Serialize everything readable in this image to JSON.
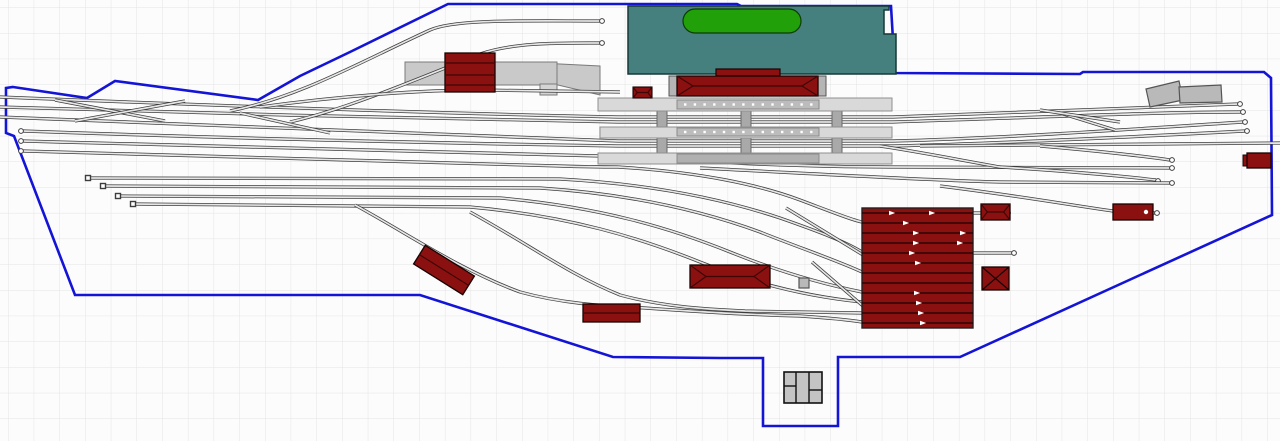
{
  "app": {
    "description": "model railway track plan canvas"
  },
  "scene": {
    "colors": {
      "bg": "#fcfcfc",
      "grid": "#e4e4e4",
      "boundary": "#1414d7",
      "rail": "#3d3d3d",
      "rail_gap": "#e6e6e6",
      "red": "#8b1111",
      "red_line": "#3f0606",
      "teal": "#46807e",
      "teal_stroke": "#17393a",
      "pond": "#22a00a",
      "pond_stroke": "#0c3b04",
      "platform": "#d9d9d9",
      "platform_stroke": "#909090",
      "strip": "#bcbcbc",
      "strip_dark": "#b0b0b0",
      "connector": "#a9a9a9",
      "gray_building": "#b9b9b9",
      "gray_building_stroke": "#555555",
      "goods_platform": "#c9c9c9",
      "goods_platform_stroke": "#7a7a7a"
    },
    "grid": {
      "size": 25.7,
      "offset_x": 8,
      "offset_y": 7.3
    },
    "boundary": {
      "points": [
        [
          13,
          87
        ],
        [
          87,
          98
        ],
        [
          115,
          81
        ],
        [
          258,
          100
        ],
        [
          300,
          76
        ],
        [
          350,
          52
        ],
        [
          448,
          4
        ],
        [
          737,
          4
        ],
        [
          741,
          6
        ],
        [
          891,
          6
        ],
        [
          893,
          40
        ],
        [
          893,
          73
        ],
        [
          1080,
          74
        ],
        [
          1083,
          72
        ],
        [
          1264,
          72
        ],
        [
          1271,
          78
        ],
        [
          1272,
          215
        ],
        [
          960,
          357
        ],
        [
          838,
          357
        ],
        [
          838,
          426
        ],
        [
          763,
          426
        ],
        [
          763,
          358
        ],
        [
          720,
          358
        ],
        [
          613,
          357
        ],
        [
          420,
          295
        ],
        [
          75,
          295
        ],
        [
          14,
          136
        ],
        [
          6,
          133
        ],
        [
          6,
          88
        ]
      ]
    },
    "park": {
      "points": [
        [
          628,
          6
        ],
        [
          889,
          6
        ],
        [
          889,
          10
        ],
        [
          884,
          10
        ],
        [
          884,
          34
        ],
        [
          896,
          34
        ],
        [
          896,
          74
        ],
        [
          628,
          74
        ]
      ],
      "pond": {
        "x": 683,
        "y": 9,
        "w": 118,
        "h": 24,
        "rx": 12
      }
    },
    "goods_area": {
      "platform": {
        "x": 405,
        "y": 62,
        "w": 152,
        "h": 23
      },
      "trapezoid": [
        [
          540,
          63
        ],
        [
          600,
          66
        ],
        [
          600,
          95
        ],
        [
          558,
          85
        ],
        [
          540,
          84
        ]
      ],
      "step": {
        "x": 540,
        "y": 84,
        "w": 17,
        "h": 11
      },
      "building": {
        "x": 445,
        "y": 53,
        "w": 50,
        "h": 39,
        "lines": [
          63,
          75,
          85
        ]
      }
    },
    "tracks": [
      {
        "name": "main-west-1",
        "d": "M0,97 C200,105 420,113 618,117 L893,117 C1050,112 1160,106 1238,104",
        "ends": [
          [
            1240,
            104
          ]
        ]
      },
      {
        "name": "main-west-2",
        "d": "M0,107 C200,113 420,119 618,122 L893,122 C1050,117 1160,112 1241,112",
        "ends": [
          [
            1243,
            112
          ]
        ]
      },
      {
        "name": "main-west-3",
        "d": "M0,117 C200,124 430,135 618,141 L893,141 C1010,138 1150,128 1243,122",
        "ends": [
          [
            1245,
            122
          ]
        ]
      },
      {
        "name": "yard-track-1",
        "d": "M23,131 C220,138 430,143 618,146 L893,146 C1010,143 1150,136 1245,131",
        "ends": [
          [
            21,
            131
          ],
          [
            1247,
            131
          ]
        ]
      },
      {
        "name": "yard-track-2",
        "d": "M23,141 C230,147 440,152 600,156 C700,162 800,167 893,167 L1170,168",
        "ends": [
          [
            21,
            141
          ],
          [
            1172,
            168
          ]
        ]
      },
      {
        "name": "yard-track-3",
        "d": "M23,151 C240,158 420,163 560,166 C590,167 610,167 618,167",
        "ends": [
          [
            21,
            151
          ]
        ]
      },
      {
        "name": "through-east",
        "d": "M920,146 C1000,145 1100,144 1280,143",
        "ends": []
      },
      {
        "name": "siding-east-1",
        "d": "M1040,146 C1100,151 1150,157 1170,160",
        "ends": [
          [
            1172,
            160
          ]
        ]
      },
      {
        "name": "siding-east-2",
        "d": "M1000,167 C1080,172 1130,177 1156,180",
        "ends": [
          [
            1158,
            181
          ]
        ]
      },
      {
        "name": "goods-track-1",
        "d": "M230,111 C300,97 360,62 430,30 C455,19 520,21 600,21",
        "ends": [
          [
            602,
            21
          ]
        ]
      },
      {
        "name": "goods-track-2",
        "d": "M290,122 C350,108 420,78 480,54 C515,42 560,43 600,43",
        "ends": [
          [
            602,
            43
          ]
        ]
      },
      {
        "name": "goods-track-3",
        "d": "M260,107 C340,96 420,90 480,90 L620,92",
        "ends": []
      },
      {
        "name": "stub-track-1",
        "d": "M88,178 L560,179 C650,184 720,198 780,218 C820,232 846,242 862,252",
        "ends": []
      },
      {
        "name": "stub-track-2",
        "d": "M103,186 L540,188 C630,194 700,210 760,232 C800,248 836,260 862,272",
        "ends": []
      },
      {
        "name": "stub-track-3",
        "d": "M118,196 L500,198 C600,207 670,228 730,252 C780,272 822,284 862,292",
        "ends": []
      },
      {
        "name": "stub-track-4",
        "d": "M133,204 L470,207 C570,216 640,238 700,262 C750,282 802,296 862,302",
        "ends": []
      },
      {
        "name": "shed-lead",
        "d": "M618,167 C700,172 760,185 800,200 C832,212 852,220 862,222",
        "ends": []
      },
      {
        "name": "shed-ladder-1",
        "d": "M786,208 L868,258",
        "ends": []
      },
      {
        "name": "shed-ladder-2",
        "d": "M812,262 L870,312",
        "ends": []
      },
      {
        "name": "bottom-curve-1",
        "d": "M355,205 C410,235 460,270 520,292 C560,303 600,306 645,308 C700,312 760,315 800,316 C830,318 850,320 862,322",
        "ends": []
      },
      {
        "name": "bottom-curve-2",
        "d": "M470,212 C530,245 570,275 620,295 C660,306 700,309 745,311 L862,313",
        "ends": []
      },
      {
        "name": "east-curve-1",
        "d": "M700,168 C820,174 920,180 1000,182 L1170,183",
        "ends": [
          [
            1172,
            183
          ]
        ]
      },
      {
        "name": "east-curve-2",
        "d": "M880,146 C920,152 960,160 1000,167",
        "ends": []
      },
      {
        "name": "depot-track-east",
        "d": "M940,186 C1020,196 1070,205 1113,211 L1155,213",
        "ends": [
          [
            1157,
            213
          ]
        ]
      },
      {
        "name": "shed-exit-1",
        "d": "M973,213 L1006,213",
        "ends": [
          [
            1008,
            213
          ]
        ]
      },
      {
        "name": "shed-exit-2",
        "d": "M973,253 L1012,253",
        "ends": [
          [
            1014,
            253
          ]
        ]
      },
      {
        "name": "crossover-1",
        "d": "M55,100 L165,121",
        "ends": []
      },
      {
        "name": "crossover-2",
        "d": "M75,121 L185,101",
        "ends": []
      },
      {
        "name": "crossover-3",
        "d": "M240,113 L330,133",
        "ends": []
      },
      {
        "name": "crossover-4",
        "d": "M1063,114 L1115,130",
        "ends": []
      },
      {
        "name": "crossover-5",
        "d": "M1040,110 L1120,122",
        "ends": []
      }
    ],
    "bumpers": [
      [
        88,
        178
      ],
      [
        103,
        186
      ],
      [
        118,
        196
      ],
      [
        133,
        204
      ]
    ],
    "connectors": [
      {
        "x": 657,
        "y": 99,
        "w": 10,
        "h": 64
      },
      {
        "x": 741,
        "y": 99,
        "w": 10,
        "h": 64
      },
      {
        "x": 832,
        "y": 99,
        "w": 10,
        "h": 64
      }
    ],
    "platforms": [
      {
        "x": 598,
        "y": 98,
        "w": 294,
        "h": 13,
        "strip": {
          "x": 677,
          "y": 100,
          "w": 142,
          "h": 9,
          "dots": true
        }
      },
      {
        "x": 600,
        "y": 127,
        "w": 292,
        "h": 11,
        "strip": {
          "x": 677,
          "y": 128,
          "w": 142,
          "h": 8,
          "dots": true
        }
      },
      {
        "x": 598,
        "y": 153,
        "w": 294,
        "h": 11,
        "strip": {
          "x": 677,
          "y": 154,
          "w": 142,
          "h": 9,
          "dots": false
        }
      }
    ],
    "station": {
      "building": {
        "x": 677,
        "y": 76,
        "w": 141,
        "h": 20
      },
      "upper": {
        "x": 716,
        "y": 69,
        "w": 64,
        "h": 7
      },
      "pillars": [
        [
          669,
          76,
          8,
          20
        ],
        [
          818,
          76,
          8,
          20
        ]
      ],
      "hut": {
        "x": 633,
        "y": 87,
        "w": 19,
        "h": 11
      }
    },
    "buildings": [
      {
        "name": "warehouse-south",
        "kind": "hip",
        "x": 690,
        "y": 265,
        "w": 80,
        "h": 23
      },
      {
        "name": "storage-south",
        "kind": "ridge",
        "x": 583,
        "y": 304,
        "w": 57,
        "h": 18
      },
      {
        "name": "rotated-shed",
        "kind": "ridge",
        "x": 415,
        "y": 259,
        "w": 58,
        "h": 22,
        "rotate": 32
      },
      {
        "name": "depot-hut-north",
        "kind": "hip",
        "x": 981,
        "y": 204,
        "w": 29,
        "h": 16
      },
      {
        "name": "depot-hut-south",
        "kind": "x",
        "x": 982,
        "y": 267,
        "w": 27,
        "h": 23
      },
      {
        "name": "east-shed",
        "kind": "flat",
        "x": 1113,
        "y": 204,
        "w": 40,
        "h": 16,
        "dot": [
          1146,
          212
        ]
      },
      {
        "name": "east-edge-hut",
        "kind": "flat",
        "x": 1247,
        "y": 153,
        "w": 24,
        "h": 15,
        "annex": [
          1243,
          155,
          6,
          11
        ]
      }
    ],
    "engine_shed": {
      "x": 862,
      "y": 208,
      "w": 111,
      "h": 120,
      "rows": [
        213,
        223,
        233,
        243,
        253,
        263,
        273,
        283,
        293,
        303,
        313,
        323
      ],
      "arrows": [
        [
          892,
          213
        ],
        [
          932,
          213
        ],
        [
          906,
          223
        ],
        [
          916,
          233
        ],
        [
          916,
          243
        ],
        [
          912,
          253
        ],
        [
          918,
          263
        ],
        [
          963,
          233
        ],
        [
          960,
          243
        ],
        [
          917,
          293
        ],
        [
          919,
          303
        ],
        [
          921,
          313
        ],
        [
          923,
          323
        ]
      ]
    },
    "parallelograms": [
      [
        [
          1146,
          89
        ],
        [
          1179,
          81
        ],
        [
          1183,
          100
        ],
        [
          1150,
          107
        ]
      ],
      [
        [
          1179,
          87
        ],
        [
          1221,
          85
        ],
        [
          1222,
          102
        ],
        [
          1180,
          103
        ]
      ]
    ],
    "gray_square": {
      "x": 799,
      "y": 278,
      "w": 10,
      "h": 10
    },
    "notch_building": {
      "x": 784,
      "y": 372,
      "w": 38,
      "h": 31,
      "vlines": [
        796,
        809
      ],
      "hsplits": [
        [
          784,
          796,
          386
        ],
        [
          809,
          822,
          390
        ]
      ]
    }
  }
}
